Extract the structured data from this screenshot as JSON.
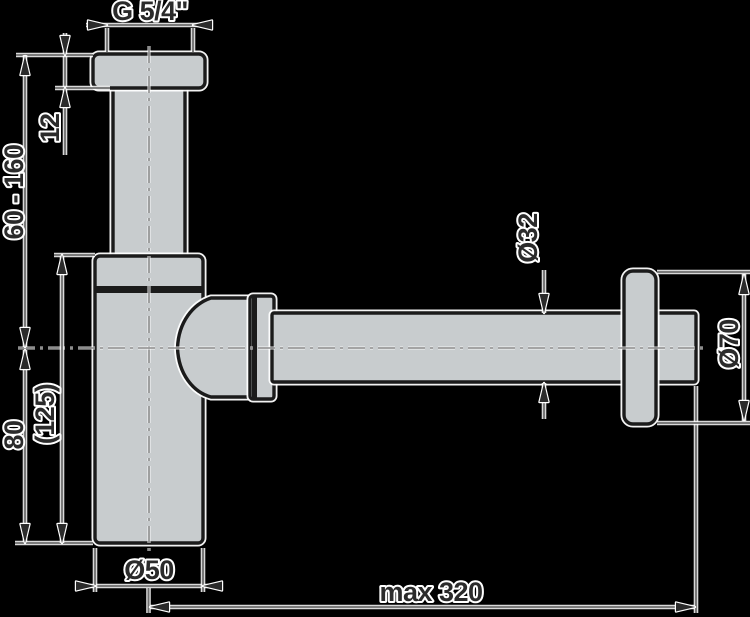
{
  "drawing": {
    "kind": "technical dimension drawing",
    "subject": "bottle trap siphon with wall rosette"
  },
  "dims": {
    "thread": "G 5/4\"",
    "flange_thickness": "12",
    "height_adjust": "60 - 160",
    "outlet_height": "80",
    "body_height": "(125)",
    "body_diameter": "Ø50",
    "pipe_diameter": "Ø32",
    "rosette_diameter": "Ø70",
    "max_reach": "max 320"
  },
  "colors": {
    "background": "#000000",
    "part_fill": "#c8ccce",
    "part_outline": "#1b1b1b",
    "dimension_line": "#6f6f6f",
    "centerline": "#8d8d8d",
    "halo": "#ffffff",
    "label_text": "#2b2b2b"
  }
}
